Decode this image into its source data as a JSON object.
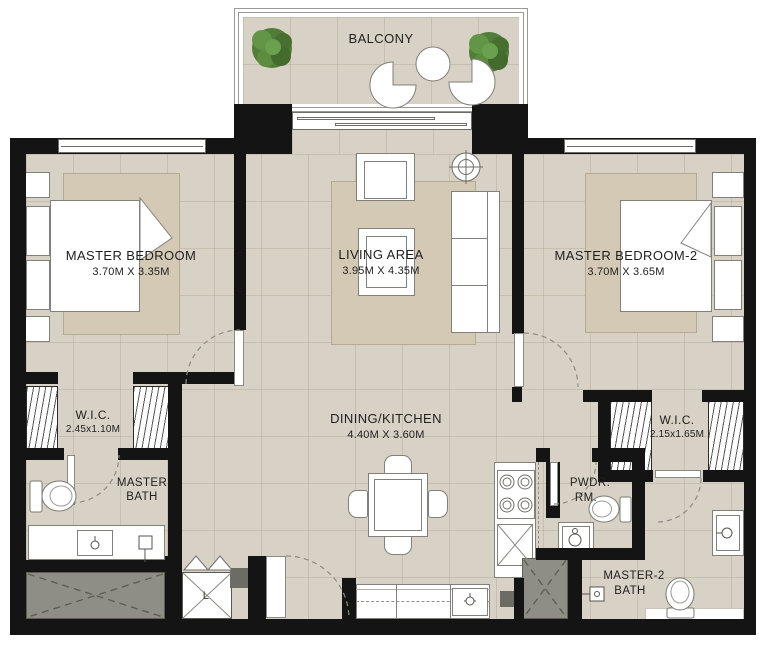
{
  "rooms": {
    "balcony": {
      "name": "BALCONY"
    },
    "living": {
      "name": "LIVING AREA",
      "dims": "3.95M X 4.35M"
    },
    "master_bedroom": {
      "name": "MASTER BEDROOM",
      "dims": "3.70M X 3.35M"
    },
    "master_bedroom_2": {
      "name": "MASTER BEDROOM-2",
      "dims": "3.70M X 3.65M"
    },
    "dining_kitchen": {
      "name": "DINING/KITCHEN",
      "dims": "4.40M X 3.60M"
    },
    "wic_1": {
      "name": "W.I.C.",
      "dims": "2.45x1.10M"
    },
    "wic_2": {
      "name": "W.I.C.",
      "dims": "2.15x1.65M"
    },
    "master_bath": {
      "line1": "MASTER",
      "line2": "BATH"
    },
    "powder_room": {
      "line1": "PWDR.",
      "line2": "RM."
    },
    "master_2_bath": {
      "line1": "MASTER-2",
      "line2": "BATH"
    },
    "laundry": {
      "name": "L"
    }
  },
  "colors": {
    "wall": "#141414",
    "floor": "#d8d1c6",
    "rug": "#d4c9b4",
    "shaft_gray": "#8f8e86",
    "plant_green": "#517d38",
    "outline_gray": "#81807a"
  }
}
